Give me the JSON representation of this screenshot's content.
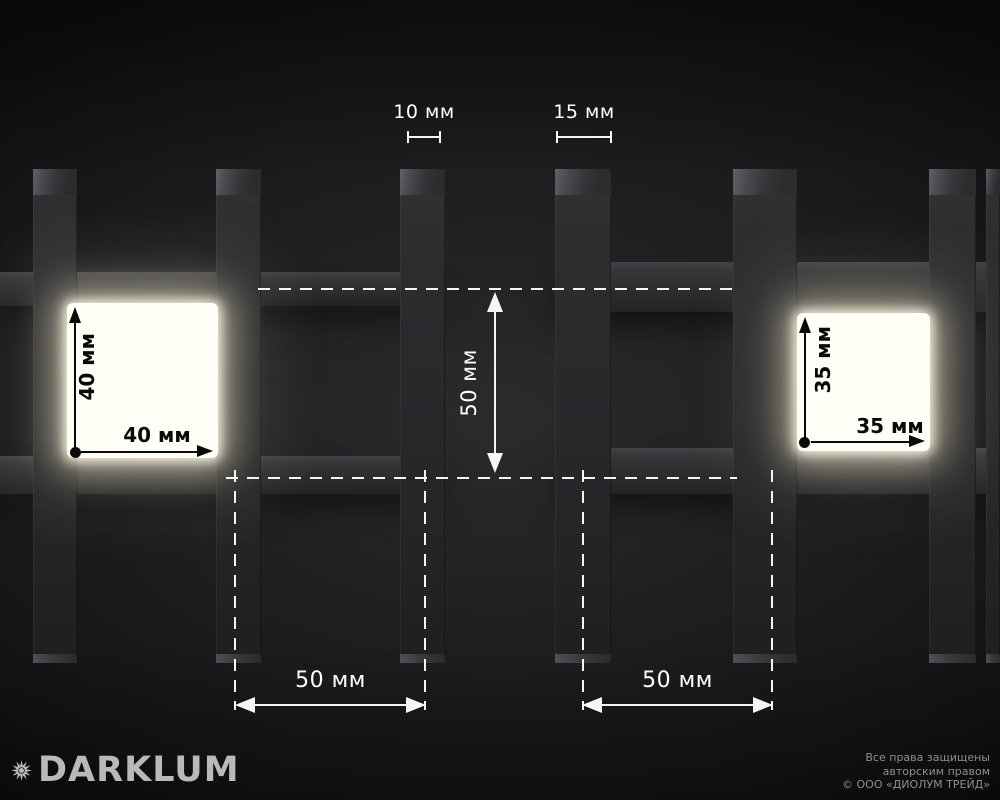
{
  "annotations": {
    "slat_width_left": {
      "label": "10 мм"
    },
    "slat_width_right": {
      "label": "15 мм"
    },
    "cell_height_center": {
      "label": "50 мм"
    },
    "left_cell": {
      "height_label": "40 мм",
      "width_label": "40 мм"
    },
    "right_cell": {
      "height_label": "35 мм",
      "width_label": "35 мм"
    },
    "pitch_left": {
      "label": "50 мм"
    },
    "pitch_right": {
      "label": "50 мм"
    }
  },
  "footer": {
    "logo_text": "DARKLUM",
    "copyright_lines": [
      "Все права защищены",
      "авторским правом",
      "© ООО «ДИОЛУМ ТРЕЙД»"
    ]
  },
  "icons": {
    "logo": "sunburst-icon"
  },
  "colors": {
    "background_center": "#2b2b2e",
    "background_edge": "#0d0d0f",
    "slat": "#2b2b2e",
    "rail": "#343438",
    "annotation_white": "#f5f5f5",
    "annotation_black": "#0a0a0a",
    "glow_fill": "#fffef7",
    "glow_halo": "#e9e2c4",
    "logo_gray": "#b9b9b9",
    "copyright_gray": "#8e8e93"
  }
}
